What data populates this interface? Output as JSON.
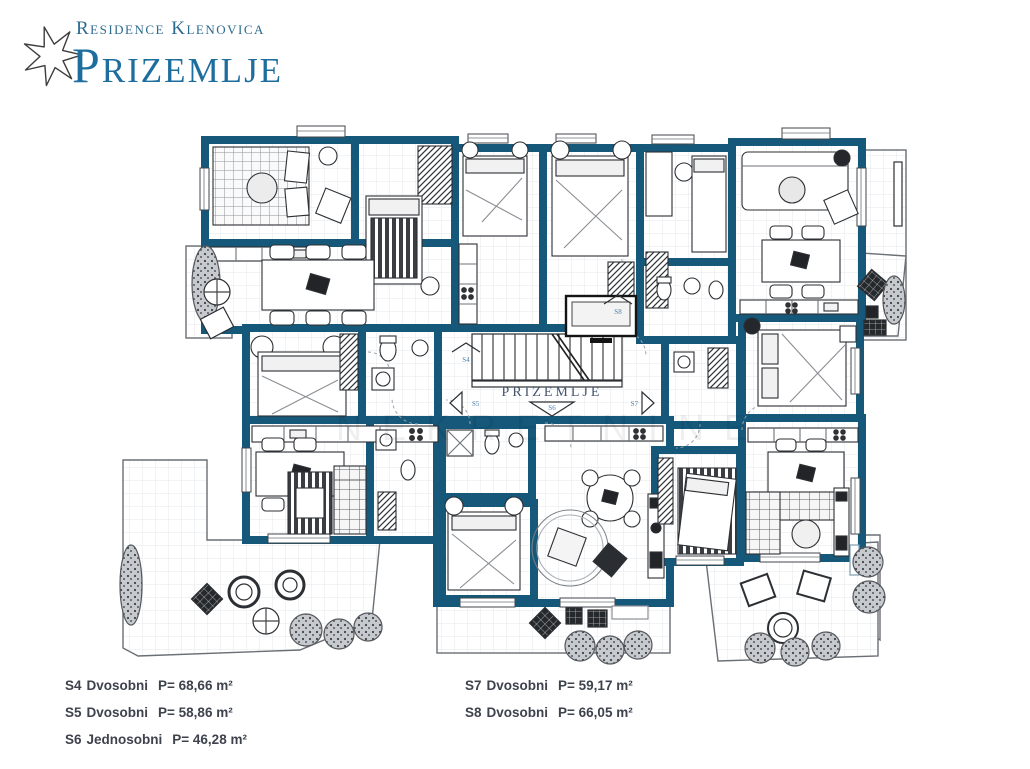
{
  "header": {
    "brand": "Residence Klenovica",
    "title": "Prizemlje",
    "logo_icon": "star-icon"
  },
  "plan": {
    "floor_label": "PRIZEMLJE",
    "watermark": "NEKRETNINE",
    "unit_markers": [
      {
        "code": "S4"
      },
      {
        "code": "S5"
      },
      {
        "code": "S6"
      },
      {
        "code": "S7"
      },
      {
        "code": "S8"
      }
    ],
    "colors": {
      "wall": "#15587a",
      "brand_blue": "#2c6a90",
      "title_blue": "#1d6e9e",
      "legend_text": "#3d424d",
      "marker_blue": "#4a7fae"
    }
  },
  "legend": {
    "columns": [
      {
        "items": [
          {
            "code": "S4",
            "type": "Dvosobni",
            "area": "P= 68,66 m²"
          },
          {
            "code": "S5",
            "type": "Dvosobni",
            "area": "P= 58,86 m²"
          },
          {
            "code": "S6",
            "type": "Jednosobni",
            "area": "P= 46,28 m²"
          }
        ]
      },
      {
        "items": [
          {
            "code": "S7",
            "type": "Dvosobni",
            "area": "P= 59,17 m²"
          },
          {
            "code": "S8",
            "type": "Dvosobni",
            "area": "P= 66,05 m²"
          }
        ]
      }
    ]
  }
}
